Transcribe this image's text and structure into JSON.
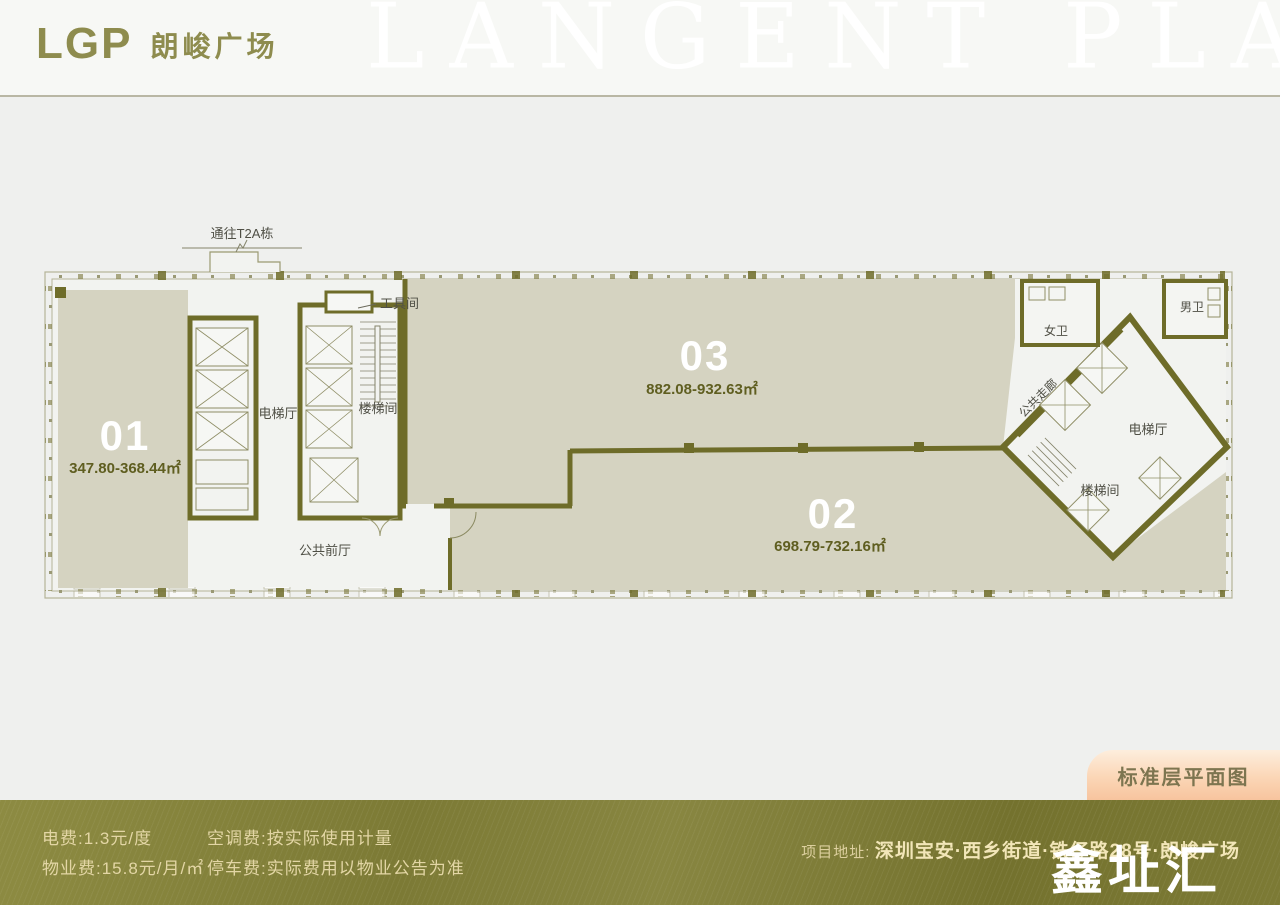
{
  "colors": {
    "wall_olive": "#6e6c29",
    "floor_beige": "#d5d3c1",
    "brand_olive": "#8e8c4e",
    "footer_olive": "#7c7a35",
    "badge_peach": "#f7c49e",
    "footer_text_cream": "#e3d6a5"
  },
  "header": {
    "logo_text": "LGP",
    "brand_name": "朗峻广场",
    "watermark": "LANGENT PLAZA"
  },
  "floor_plan": {
    "t2a_label": "通往T2A栋",
    "units": {
      "u01": {
        "number": "01",
        "area": "347.80-368.44㎡"
      },
      "u02": {
        "number": "02",
        "area": "698.79-732.16㎡"
      },
      "u03": {
        "number": "03",
        "area": "882.08-932.63㎡"
      }
    },
    "rooms": {
      "elevator_hall_left": "电梯厅",
      "stairwell_left": "楼梯间",
      "tool_room": "工具间",
      "lobby": "公共前厅",
      "corridor": "公共走廊",
      "women_wc": "女卫",
      "men_wc": "男卫",
      "elevator_hall_right": "电梯厅",
      "stairwell_right": "楼梯间"
    }
  },
  "badge": {
    "label": "标准层平面图"
  },
  "footer": {
    "fees": [
      "电费:1.3元/度",
      "物业费:15.8元/月/㎡",
      "空调费:按实际使用计量",
      "停车费:实际费用以物业公告为准"
    ],
    "address_label": "项目地址:",
    "address": "深圳宝安·西乡街道·铁仔路28号·朗峻广场",
    "watermark": "鑫址汇"
  }
}
